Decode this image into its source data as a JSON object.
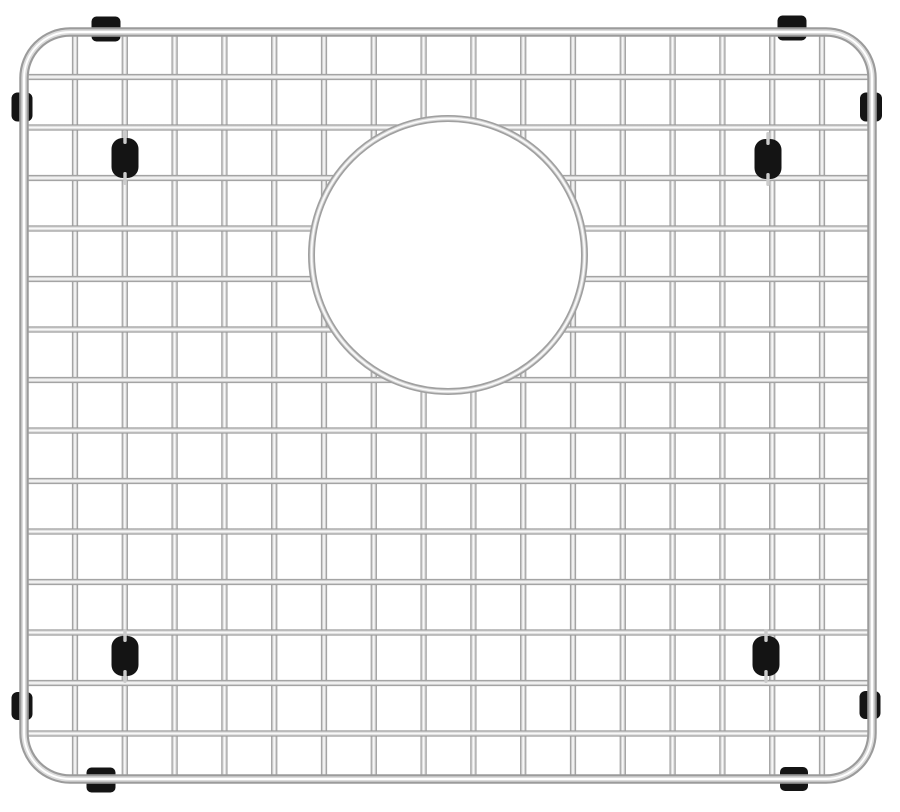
{
  "scene": {
    "type": "product-photo",
    "subject": "stainless-steel-sink-bottom-grid",
    "features": [
      "wire-grid",
      "circular-drain-cutout",
      "rubber-corner-feet",
      "rubber-frame-bumpers"
    ],
    "background_color": "#ffffff"
  },
  "canvas": {
    "width": 900,
    "height": 812
  },
  "colors": {
    "background": "#ffffff",
    "wire_edge": "#8a8a8a",
    "wire_mid": "#d6d6d6",
    "wire_highlight": "#ffffff",
    "frame_base": "#9b9b9b",
    "frame_mid": "#dcdcdc",
    "frame_highlight": "#ffffff",
    "ring_base": "#a0a0a0",
    "ring_mid": "#d8d8d8",
    "ring_highlight": "#fbfbfb",
    "rubber_black": "#141414",
    "stub_silver": "#cccccc"
  },
  "frame": {
    "x": 24,
    "y": 32,
    "width": 848,
    "height": 747,
    "radius": 46,
    "thickness": 9.5
  },
  "vertical_wires": {
    "count": 16,
    "first_x": 75,
    "pitch": 49.8,
    "top": 30,
    "bottom": 779,
    "thickness": 6.2
  },
  "horizontal_wires": {
    "count": 14,
    "first_y": 77,
    "pitch": 50.5,
    "left": 25,
    "right": 871,
    "thickness": 6.2
  },
  "drain": {
    "cx": 448,
    "cy": 255,
    "radius": 136.5,
    "ring_thickness": 7
  },
  "foot_size": {
    "w": 27,
    "h": 40,
    "r": 11
  },
  "feet": [
    {
      "cx": 125,
      "cy": 158
    },
    {
      "cx": 768,
      "cy": 159
    },
    {
      "cx": 125,
      "cy": 656
    },
    {
      "cx": 766,
      "cy": 656
    }
  ],
  "clamps": [
    {
      "cx": 106,
      "cy": 29,
      "w": 29,
      "h": 25,
      "r": 5,
      "edge": "top"
    },
    {
      "cx": 792,
      "cy": 28,
      "w": 29,
      "h": 25,
      "r": 5,
      "edge": "top"
    },
    {
      "cx": 101,
      "cy": 780,
      "w": 29,
      "h": 25,
      "r": 5,
      "edge": "bottom"
    },
    {
      "cx": 794,
      "cy": 779,
      "w": 28,
      "h": 24,
      "r": 5,
      "edge": "bottom"
    },
    {
      "cx": 22,
      "cy": 107,
      "w": 21,
      "h": 29,
      "r": 6,
      "edge": "left"
    },
    {
      "cx": 22,
      "cy": 706,
      "w": 21,
      "h": 28,
      "r": 6,
      "edge": "left"
    },
    {
      "cx": 871,
      "cy": 107,
      "w": 22,
      "h": 29,
      "r": 6,
      "edge": "right"
    },
    {
      "cx": 870,
      "cy": 705,
      "w": 21,
      "h": 28,
      "r": 6,
      "edge": "right"
    }
  ]
}
